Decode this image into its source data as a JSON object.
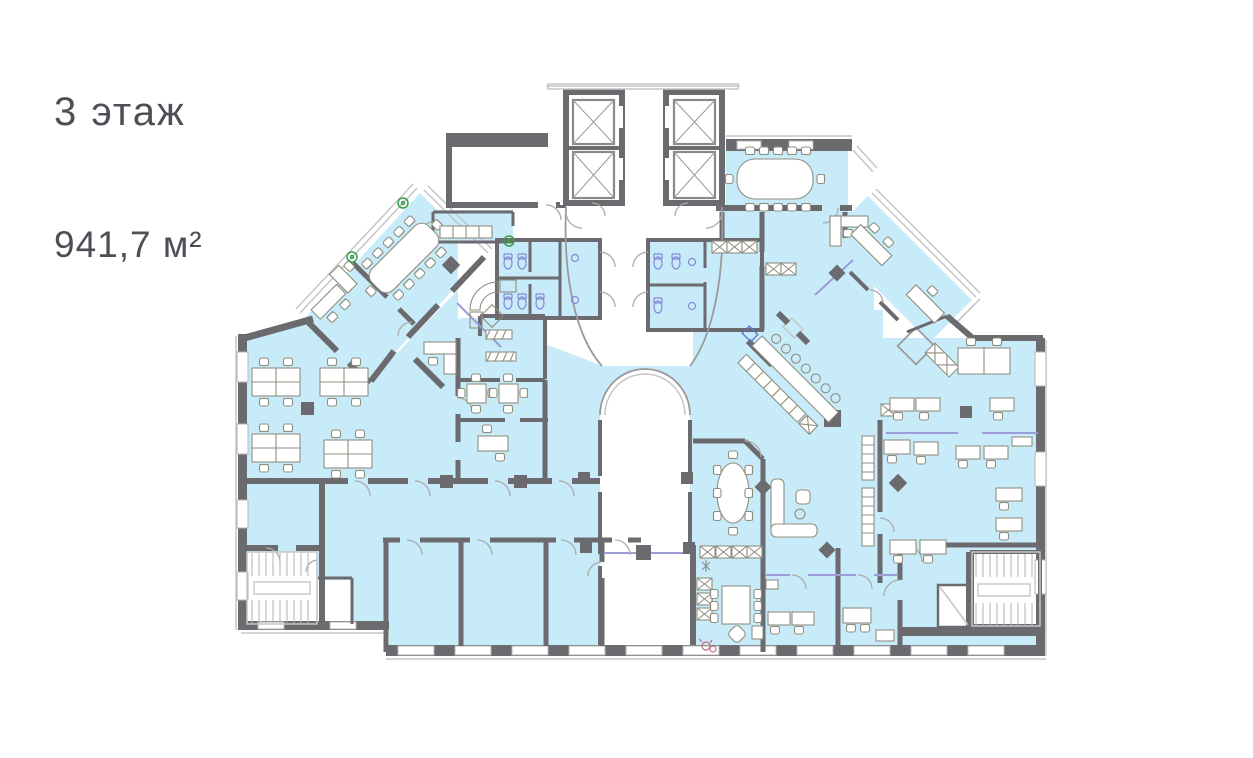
{
  "header": {
    "floor_label": "3 этаж",
    "area_label": "941,7 м²"
  },
  "colors": {
    "room_fill": "#c8ebf9",
    "wall": "#6b6a6e",
    "outline": "#c6c6c6",
    "furniture": "#8f8f80",
    "glass": "#9c9cd8",
    "fixture": "#8787d8",
    "plant": "#3a9e4e",
    "flower": "#c4707e",
    "text": "#4e4e57",
    "background": "#ffffff"
  },
  "plan": {
    "type": "office-floor-plan",
    "highlighted_area_meaning": "leasable office space (blue)",
    "features": [
      "elevator-core-with-4-shafts",
      "central-atrium-with-arched-wall",
      "left-staircase",
      "right-staircase",
      "open-office-left-with-desk-clusters",
      "diagonal-meeting-wing-left",
      "diagonal-office-wing-right",
      "meeting-room-top-right",
      "kitchen-bar-diagonal-counter",
      "wc-blocks",
      "oval-meeting-room",
      "lounge-sofa-area",
      "open-office-right",
      "perimeter-windows"
    ]
  }
}
